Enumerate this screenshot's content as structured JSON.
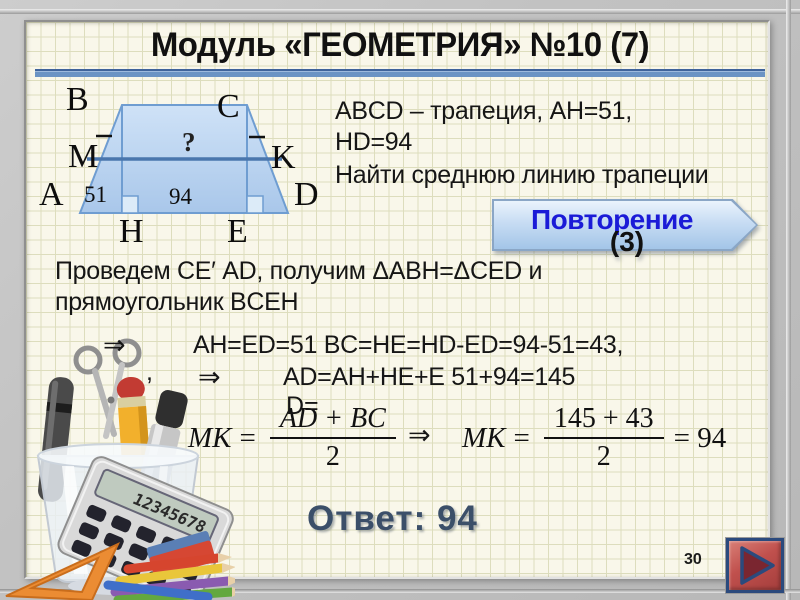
{
  "title": "Модуль «ГЕОМЕТРИЯ» №10 (7)",
  "problem": {
    "line1": "ABCD – трапеция, AH=51,",
    "line2": "HD=94",
    "task": "Найти среднюю линию трапеции"
  },
  "repeat_button": {
    "label": "Повторение",
    "count": "(3)"
  },
  "diagram": {
    "labels": {
      "a": "A",
      "b": "B",
      "c": "C",
      "d": "D",
      "m": "M",
      "k": "K",
      "h": "H",
      "e": "E"
    },
    "question_mark": "?",
    "ah_value": "51",
    "he_value": "94"
  },
  "solution": {
    "line1": "Проведем СЕ′ AD, получим ΔABH=ΔCED и",
    "line2": "прямоугольник  BCEH",
    "implies1": "⇒",
    "line3": "AH=ED=51  BC=HE=HD-ED=94-51=43,",
    "comma": ",",
    "implies2": "⇒",
    "line4": "AD=AH+HE+E   51+94=145",
    "wrap": "D=",
    "formula1": {
      "lhs": "MK",
      "eq": "=",
      "num": "AD + BC",
      "den": "2"
    },
    "implies3": "⇒",
    "formula2": {
      "lhs": "MK",
      "eq": "=",
      "num": "145 + 43",
      "den": "2",
      "rhs": "= 94"
    }
  },
  "answer": "Ответ: 94",
  "page_number": "30",
  "decor": {
    "calculator_display": "12345678"
  },
  "colors": {
    "accent_blue": "#6b93c4",
    "line_dark": "#3f639b",
    "button_text_blue": "#1b1bd7",
    "answer_navy": "#3b4f69",
    "nav_red": "#c0504d",
    "nav_navy": "#2b4a7d",
    "trap_fill": "#bcd6f2",
    "trap_stroke": "#6f9dd1",
    "midline_blue": "#4a76ad"
  }
}
